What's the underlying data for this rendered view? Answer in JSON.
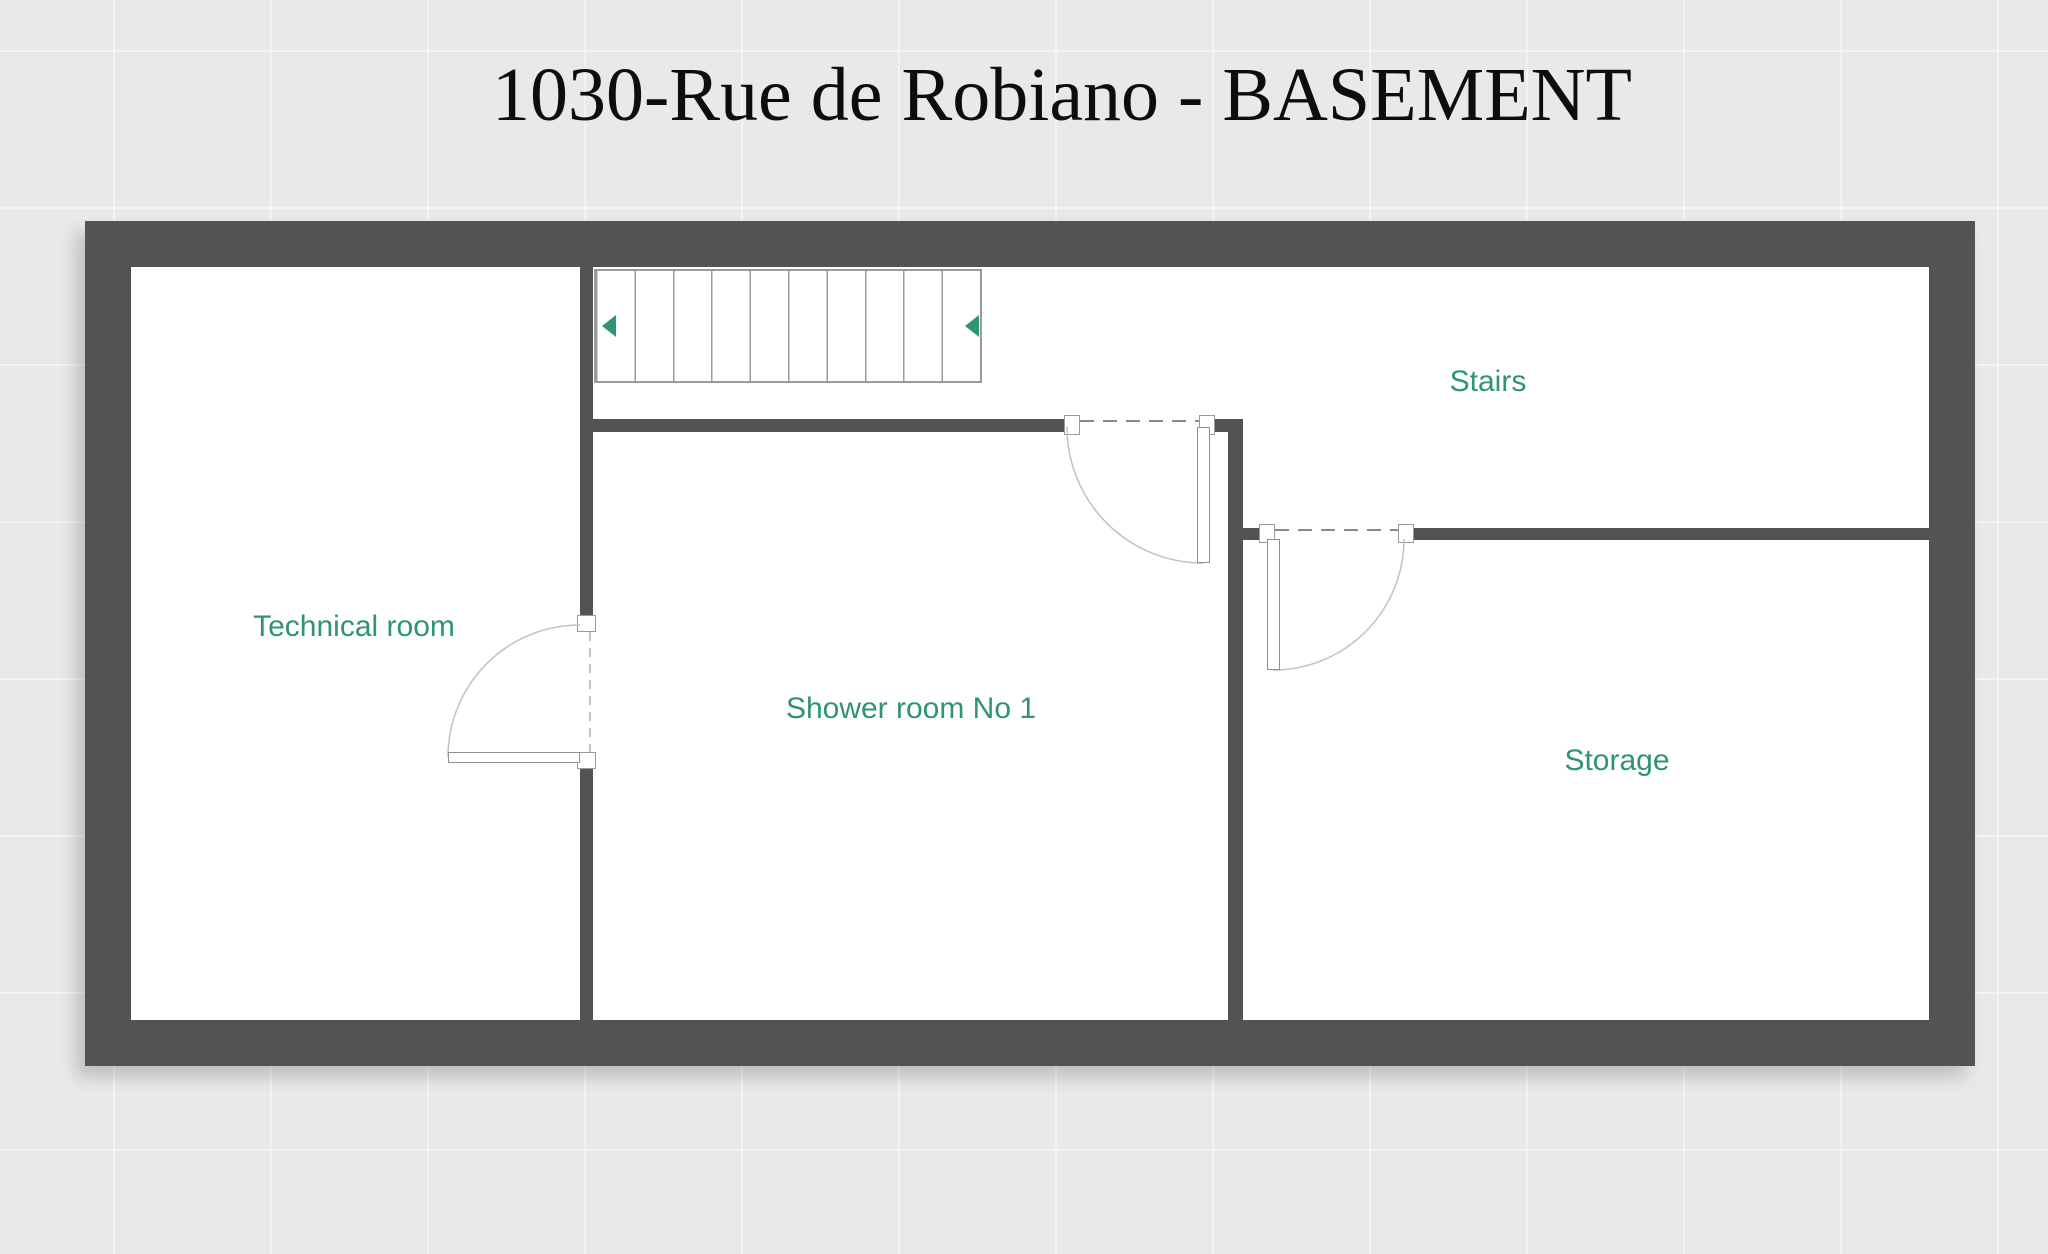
{
  "title": "1030-Rue de Robiano - BASEMENT",
  "floor_name": "BASEMENT",
  "address": "1030-Rue de Robiano",
  "rooms": [
    {
      "label": "Technical room"
    },
    {
      "label": "Shower room No 1"
    },
    {
      "label": "Stairs"
    },
    {
      "label": "Storage"
    }
  ],
  "stairs": {
    "treads": 10,
    "direction_icons": [
      "left-arrow",
      "left-arrow"
    ]
  },
  "doors": [
    {
      "between": "Technical room / Shower room No 1",
      "swing": "quarter-arc"
    },
    {
      "between": "Shower room No 1 / Stairs landing",
      "swing": "quarter-arc"
    },
    {
      "between": "Storage / Stairs landing",
      "swing": "quarter-arc"
    }
  ],
  "colors": {
    "wall": "#535353",
    "room_label": "#2f9377",
    "background": "#e9e9e9",
    "stair_arrow": "#2f9377",
    "floor_fill": "#ffffff",
    "thin_outline": "#9a9a9a"
  }
}
